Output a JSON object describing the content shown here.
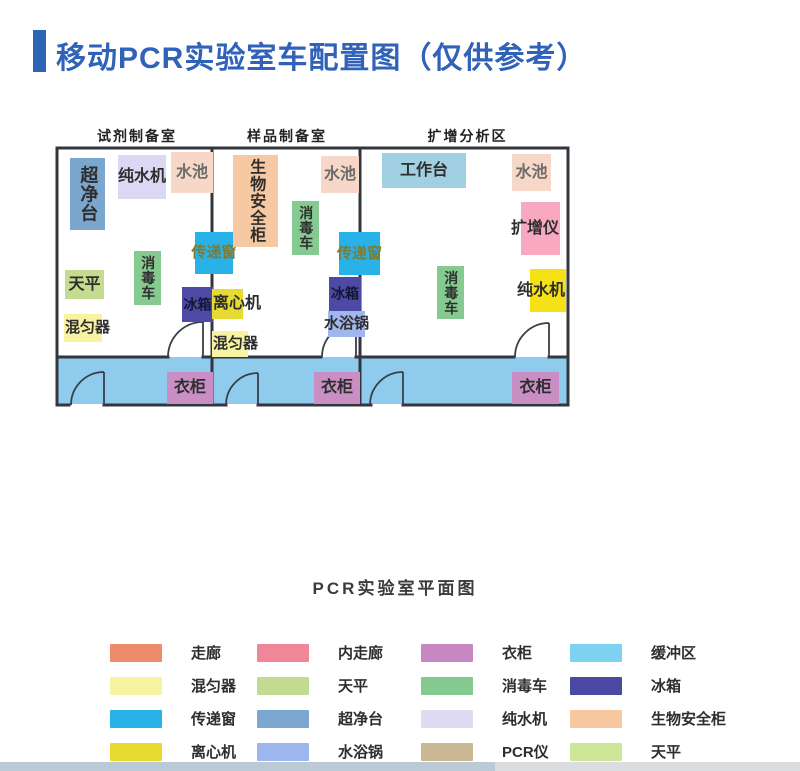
{
  "title": {
    "text": "移动PCR实验室车配置图（仅供参考）",
    "color": "#2f62b8"
  },
  "floorplan": {
    "rooms": [
      {
        "id": "reagent-prep-room",
        "name": "试剂制备室"
      },
      {
        "id": "sample-prep-room",
        "name": "样品制备室"
      },
      {
        "id": "amplification-area",
        "name": "扩增分析区"
      }
    ],
    "colors": {
      "wall": "#33363d",
      "corridor_fill": "#8ecbed",
      "door_stroke": "#3a3f45"
    },
    "equipment": [
      {
        "id": "clean-bench",
        "label": "超净台",
        "x": 70,
        "y": 158,
        "w": 35,
        "h": 72,
        "bg": "#7ba7cf",
        "vertical": true,
        "fs": 18
      },
      {
        "id": "pure-water-machine-1",
        "label": "纯水机",
        "x": 118,
        "y": 155,
        "w": 48,
        "h": 44,
        "bg": "#dad8f2",
        "fs": 16
      },
      {
        "id": "sink-1",
        "label": "水池",
        "x": 171,
        "y": 152,
        "w": 42,
        "h": 41,
        "bg": "#f7d8c8",
        "fs": 16,
        "color": "#6b6b6b"
      },
      {
        "id": "transfer-window-1",
        "label": "传递窗",
        "x": 195,
        "y": 232,
        "w": 38,
        "h": 42,
        "bg": "#29b2e8",
        "fs": 15,
        "color": "#7c7c33"
      },
      {
        "id": "disinfection-cart-1",
        "label": "消毒车",
        "x": 134,
        "y": 251,
        "w": 27,
        "h": 54,
        "bg": "#85ca90",
        "vertical": true,
        "fs": 14
      },
      {
        "id": "balance-1",
        "label": "天平",
        "x": 65,
        "y": 270,
        "w": 39,
        "h": 29,
        "bg": "#c3dc90",
        "fs": 16
      },
      {
        "id": "fridge-1",
        "label": "冰箱",
        "x": 182,
        "y": 287,
        "w": 31,
        "h": 35,
        "bg": "#4d4aa6",
        "fs": 14,
        "color": "#111831"
      },
      {
        "id": "mixer-1",
        "label": "混匀器",
        "x": 64,
        "y": 314,
        "w": 38,
        "h": 28,
        "bg": "#f8f3a2",
        "fs": 15,
        "anchor": "left"
      },
      {
        "id": "biosafety-cabinet",
        "label": "生物安全柜",
        "x": 233,
        "y": 155,
        "w": 45,
        "h": 92,
        "bg": "#f6c9a3",
        "vertical": true,
        "fs": 16
      },
      {
        "id": "sink-2",
        "label": "水池",
        "x": 321,
        "y": 156,
        "w": 38,
        "h": 37,
        "bg": "#f7d8c8",
        "fs": 16,
        "color": "#6b6b6b"
      },
      {
        "id": "disinfection-cart-2",
        "label": "消毒车",
        "x": 292,
        "y": 201,
        "w": 27,
        "h": 54,
        "bg": "#85ca90",
        "vertical": true,
        "fs": 14
      },
      {
        "id": "transfer-window-2",
        "label": "传递窗",
        "x": 339,
        "y": 232,
        "w": 41,
        "h": 43,
        "bg": "#29b2e8",
        "fs": 15,
        "color": "#7c7c33"
      },
      {
        "id": "fridge-2",
        "label": "冰箱",
        "x": 329,
        "y": 277,
        "w": 32,
        "h": 34,
        "bg": "#4d4aa6",
        "fs": 14,
        "color": "#111831"
      },
      {
        "id": "centrifuge",
        "label": "离心机",
        "x": 212,
        "y": 289,
        "w": 31,
        "h": 30,
        "bg": "#e7da31",
        "fs": 16,
        "anchor": "left"
      },
      {
        "id": "water-bath",
        "label": "水浴锅",
        "x": 328,
        "y": 311,
        "w": 37,
        "h": 26,
        "bg": "#9fb7ed",
        "fs": 15
      },
      {
        "id": "mixer-2",
        "label": "混匀器",
        "x": 212,
        "y": 331,
        "w": 36,
        "h": 26,
        "bg": "#f8f3a2",
        "fs": 15,
        "anchor": "left"
      },
      {
        "id": "workbench",
        "label": "工作台",
        "x": 382,
        "y": 153,
        "w": 84,
        "h": 35,
        "bg": "#a0d0e2",
        "fs": 16
      },
      {
        "id": "sink-3",
        "label": "水池",
        "x": 512,
        "y": 154,
        "w": 39,
        "h": 37,
        "bg": "#f7d8c8",
        "fs": 16,
        "color": "#6b6b6b"
      },
      {
        "id": "amplifier",
        "label": "扩增仪",
        "x": 521,
        "y": 202,
        "w": 39,
        "h": 53,
        "bg": "#f8a9c1",
        "fs": 16,
        "anchor": "right"
      },
      {
        "id": "disinfection-cart-3",
        "label": "消毒车",
        "x": 437,
        "y": 266,
        "w": 27,
        "h": 53,
        "bg": "#85ca90",
        "vertical": true,
        "fs": 14
      },
      {
        "id": "pure-water-machine-2",
        "label": "纯水机",
        "x": 530,
        "y": 269,
        "w": 36,
        "h": 43,
        "bg": "#f5e216",
        "fs": 16,
        "anchor": "right"
      },
      {
        "id": "wardrobe-1",
        "label": "衣柜",
        "x": 167,
        "y": 372,
        "w": 46,
        "h": 32,
        "bg": "#c98fc5",
        "fs": 16
      },
      {
        "id": "wardrobe-2",
        "label": "衣柜",
        "x": 314,
        "y": 372,
        "w": 46,
        "h": 32,
        "bg": "#c98fc5",
        "fs": 16
      },
      {
        "id": "wardrobe-3",
        "label": "衣柜",
        "x": 512,
        "y": 372,
        "w": 47,
        "h": 32,
        "bg": "#c98fc5",
        "fs": 16
      }
    ]
  },
  "legend": {
    "title": "PCR实验室平面图",
    "items": [
      {
        "id": "corridor",
        "label": "走廊",
        "color": "#ee8b6c"
      },
      {
        "id": "inner-corridor",
        "label": "内走廊",
        "color": "#ef8799"
      },
      {
        "id": "wardrobe",
        "label": "衣柜",
        "color": "#c687c2"
      },
      {
        "id": "buffer-zone",
        "label": "缓冲区",
        "color": "#7ed2f1"
      },
      {
        "id": "mixer",
        "label": "混匀器",
        "color": "#f8f3a2"
      },
      {
        "id": "balance",
        "label": "天平",
        "color": "#c3db90"
      },
      {
        "id": "disinfection-cart",
        "label": "消毒车",
        "color": "#84c98f"
      },
      {
        "id": "fridge",
        "label": "冰箱",
        "color": "#4c49a5"
      },
      {
        "id": "transfer-window",
        "label": "传递窗",
        "color": "#29b2e8"
      },
      {
        "id": "clean-bench",
        "label": "超净台",
        "color": "#7ba7d0"
      },
      {
        "id": "pure-water-machine",
        "label": "纯水机",
        "color": "#dedcf3"
      },
      {
        "id": "biosafety-cabinet",
        "label": "生物安全柜",
        "color": "#f8c9a1"
      },
      {
        "id": "centrifuge-l",
        "label": "离心机",
        "color": "#e7da31"
      },
      {
        "id": "water-bath-l",
        "label": "水浴锅",
        "color": "#9db6ed"
      },
      {
        "id": "pcr-instrument",
        "label": "PCR仪",
        "color": "#cab794"
      },
      {
        "id": "balance-2",
        "label": "天平",
        "color": "#cde69a"
      }
    ]
  }
}
